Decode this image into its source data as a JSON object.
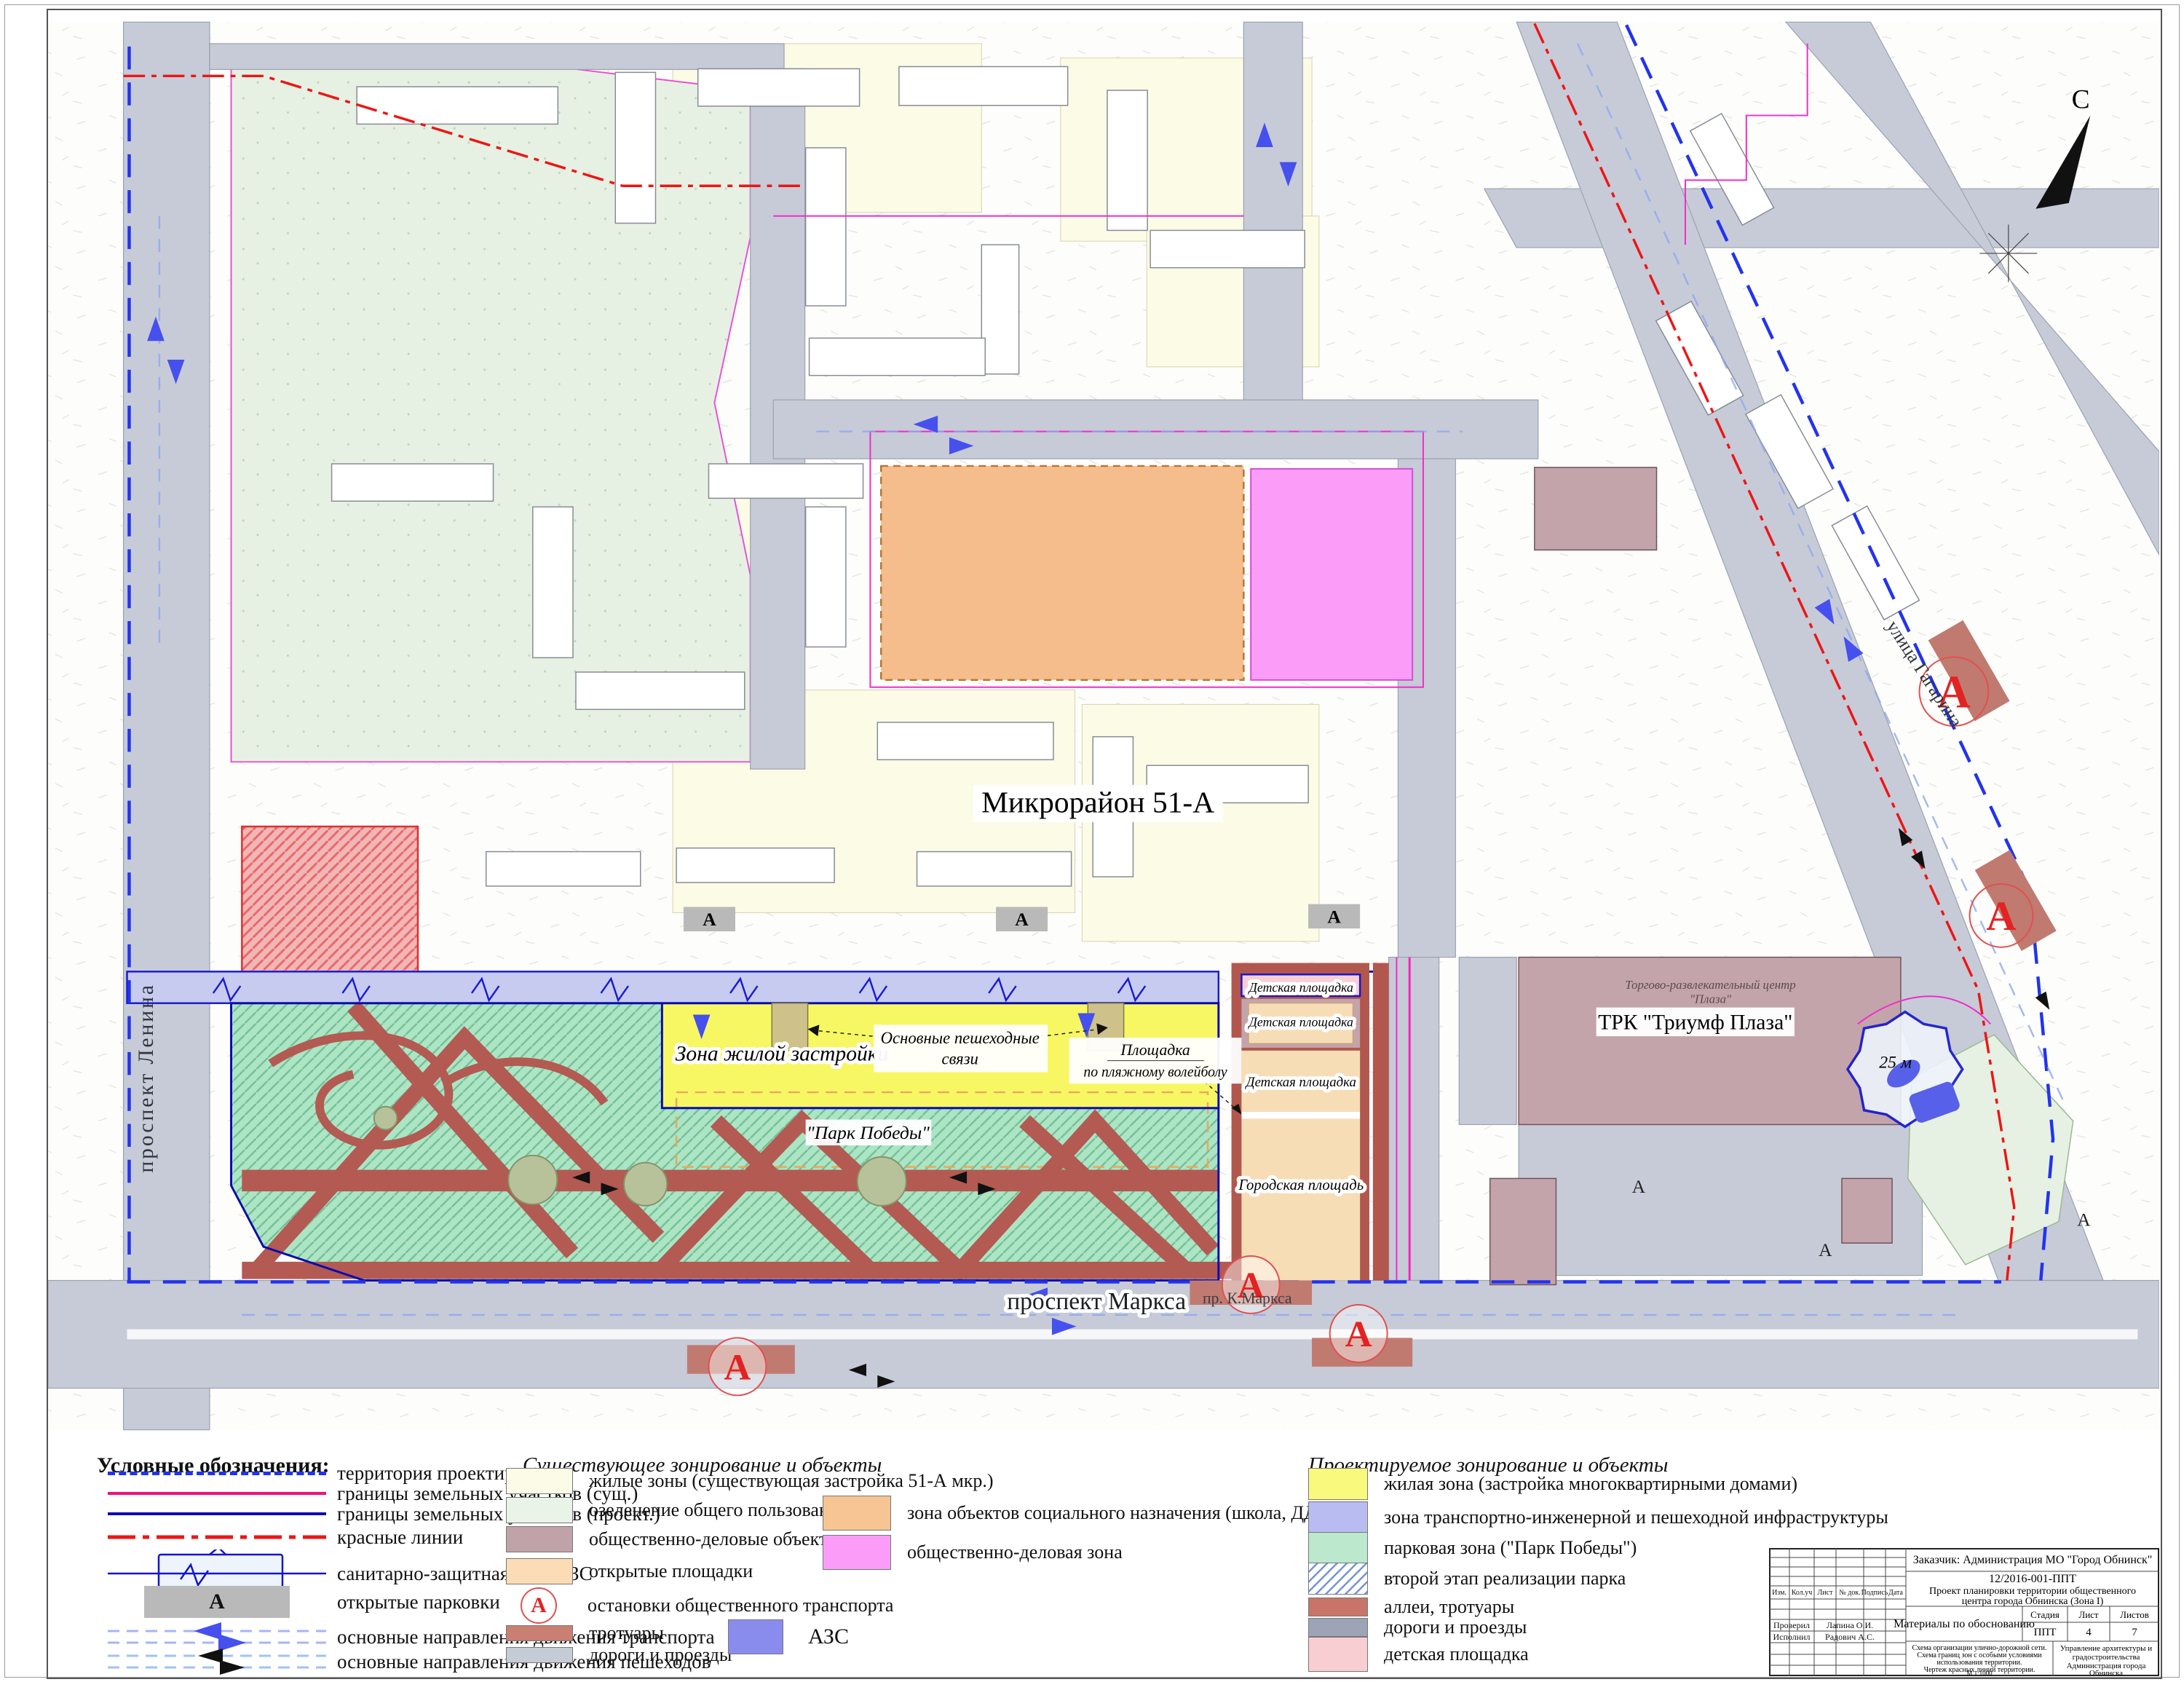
{
  "map": {
    "labels": {
      "district": "Микрорайон 51-А",
      "residential_zone": "Зона жилой застройки",
      "ped_links_1": "Основные пешеходные",
      "ped_links_2": "связи",
      "volleyball_1": "Площадка",
      "volleyball_2": "по пляжному волейболу",
      "park": "\"Парк Победы\"",
      "playground": "Детская площадка",
      "city_square": "Городская площадь",
      "mall": "ТРК \"Триумф Плаза\"",
      "mall_sub_1": "Торгово-развлекательный центр",
      "mall_sub_2": "\"Плаза\"",
      "street_lenina": "проспект Ленина",
      "street_marksa": "проспект Маркса",
      "street_marksa_short": "пр. К.Маркса",
      "street_gagarina": "улица Гагарина",
      "north": "С",
      "azs_radius": "25 м",
      "stop_letter": "А",
      "parking_letter": "А"
    }
  },
  "legend_left": {
    "title": "Условные обозначения:",
    "parking_letter": "А",
    "items": [
      {
        "label": "территория проектирования"
      },
      {
        "label": "границы земельных участков (сущ.)"
      },
      {
        "label": "границы земельных участков (проект.)"
      },
      {
        "label": "красные линии"
      },
      {
        "label": "санитарно-защитная зона АЗС"
      },
      {
        "label": "открытые парковки"
      },
      {
        "label": "основные направления движения транспорта"
      },
      {
        "label": "основные направления движения пешеходов"
      }
    ]
  },
  "legend_existing": {
    "title": "Существующее зонирование и объекты",
    "stop_letter": "А",
    "col1": [
      {
        "label": "жилые зоны (существующая застройка 51-А мкр.)",
        "color": "#fbfbe8"
      },
      {
        "label": "озеленение общего пользования",
        "color": "#e9f3e7"
      },
      {
        "label": "общественно-деловые объекты",
        "color": "#bfa3a8"
      },
      {
        "label": "открытые площадки",
        "color": "#fbdcb7"
      },
      {
        "label": "остановки общественного транспорта",
        "color": "#e32222"
      },
      {
        "label": "тротуары",
        "color": "#c97f72"
      },
      {
        "label": "дороги и проезды",
        "color": "#c6ccd6"
      }
    ],
    "col2": [
      {
        "label": "зона объектов социального назначения (школа, ДДУ)",
        "color": "#f7c493"
      },
      {
        "label": "общественно-деловая зона",
        "color": "#fb9df8"
      }
    ],
    "azs_label": "АЗС",
    "azs_color": "#8a8ced"
  },
  "legend_projected": {
    "title": "Проектируемое зонирование и объекты",
    "items": [
      {
        "label": "жилая зона (застройка многоквартирными домами)",
        "color": "#f9f97d"
      },
      {
        "label": "зона транспортно-инженерной и пешеходной инфраструктуры",
        "color": "#b9bcf1"
      },
      {
        "label": "парковая зона (\"Парк Победы\")",
        "color": "#bce9cd"
      },
      {
        "label": "второй этап реализации парка",
        "color": "#7694d6"
      },
      {
        "label": "аллеи, тротуары",
        "color": "#c87468"
      },
      {
        "label": "дороги и проезды",
        "color": "#9ca4b6"
      },
      {
        "label": "детская площадка",
        "color": "#f9ced2"
      }
    ]
  },
  "title_block": {
    "customer": "Заказчик: Администрация МО \"Город Обнинск\"",
    "doc_number": "12/2016-001-ППТ",
    "project_name_1": "Проект планировки территории общественного",
    "project_name_2": "центра города Обнинска (Зона I)",
    "materials": "Материалы по обоснованию",
    "stage_label": "Стадия",
    "sheet_label": "Лист",
    "sheets_label": "Листов",
    "stage": "ППТ",
    "sheet": "4",
    "sheets": "7",
    "scheme_1": "Схема организации улично-дорожной сети.",
    "scheme_2": "Схема границ зон с особыми условиями",
    "scheme_3": "использования территории.",
    "scheme_4": "Чертеж красных линий территории.",
    "scheme_5": "М 1:1000",
    "dept_1": "Управление архитектуры и",
    "dept_2": "градостроительства",
    "dept_3": "Администрация города",
    "dept_4": "Обнинска",
    "hdr_izm": "Изм.",
    "hdr_koluch": "Кол.уч",
    "hdr_list": "Лист",
    "hdr_doc": "№ док.",
    "hdr_podpis": "Подпись",
    "hdr_data": "Дата",
    "checked_label": "Проверил",
    "checked_name": "Лапина О.И.",
    "executed_label": "Исполнил",
    "executed_name": "Радович А.С."
  }
}
